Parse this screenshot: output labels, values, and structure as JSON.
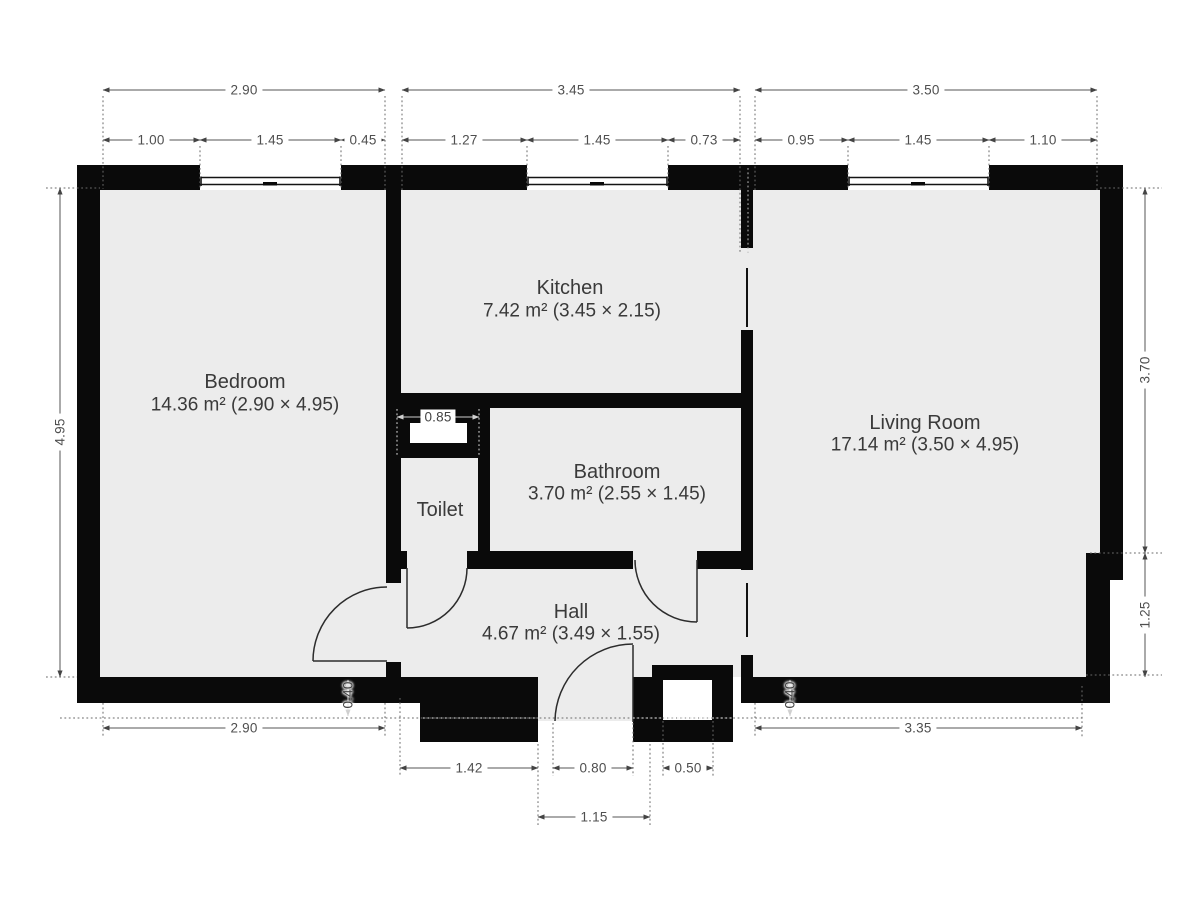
{
  "rooms": {
    "bedroom": {
      "name": "Bedroom",
      "area": "14.36 m² (2.90 × 4.95)"
    },
    "kitchen": {
      "name": "Kitchen",
      "area": "7.42 m² (3.45 × 2.15)"
    },
    "living_room": {
      "name": "Living Room",
      "area": "17.14 m² (3.50 × 4.95)"
    },
    "bathroom": {
      "name": "Bathroom",
      "area": "3.70 m² (2.55 × 1.45)"
    },
    "toilet": {
      "name": "Toilet"
    },
    "hall": {
      "name": "Hall",
      "area": "4.67 m² (3.49 × 1.55)"
    }
  },
  "dims": {
    "top1": [
      "2.90",
      "3.45",
      "3.50"
    ],
    "top2": [
      "1.00",
      "1.45",
      "0.45",
      "1.27",
      "1.45",
      "0.73",
      "0.95",
      "1.45",
      "1.10"
    ],
    "left": [
      "4.95"
    ],
    "right": [
      "3.70",
      "1.25"
    ],
    "bottom1": [
      "2.90",
      "3.35"
    ],
    "bottom2": [
      "1.42",
      "0.80",
      "0.50"
    ],
    "bottom3": [
      "1.15"
    ],
    "misc": {
      "shaft": "0.85",
      "offset_left": "0.40",
      "offset_right": "0.40"
    }
  },
  "colors": {
    "wall": "#0a0a0a",
    "floor": "#ececec",
    "dimension": "#4f4f4f",
    "background": "#ffffff"
  }
}
